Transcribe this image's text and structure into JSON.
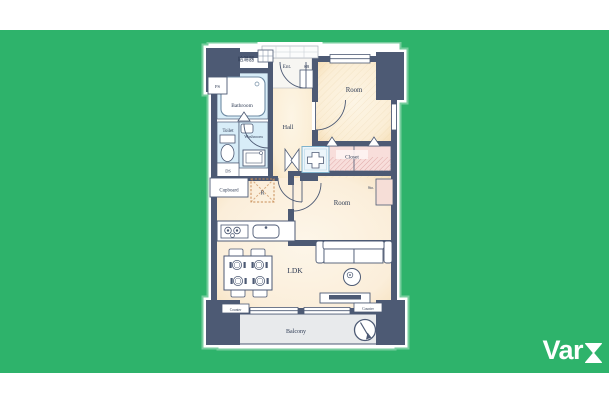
{
  "background": {
    "top_strip": "#ffffff",
    "band": "#2eb36b",
    "bottom_strip": "#ffffff"
  },
  "logo": {
    "text": "Var",
    "symbol": "hourglass-icon",
    "color": "#ffffff"
  },
  "floorplan": {
    "colors": {
      "wall": "#4d5a74",
      "floor": "#fbedd4",
      "wet_area": "#d8edf8",
      "closet": "#f8dedb",
      "balcony": "#e8eaec",
      "halo": "#9fdcba"
    },
    "labels": {
      "water_heater": "給湯器",
      "entrance": "Ent.",
      "shoe_box": "SB",
      "pipe_space": "PS",
      "bathroom": "Bathroom",
      "toilet": "Toilet",
      "washroom": "Washroom",
      "duct_space": "DS",
      "hall": "Hall",
      "room_upper": "Room",
      "closet": "Closet",
      "storage": "Sto.",
      "room_lower": "Room",
      "cupboard": "Cupboard",
      "refrigerator": "R",
      "ldk": "LDK",
      "counter_left": "Counter",
      "counter_right": "Counter",
      "balcony": "Balcony"
    }
  }
}
